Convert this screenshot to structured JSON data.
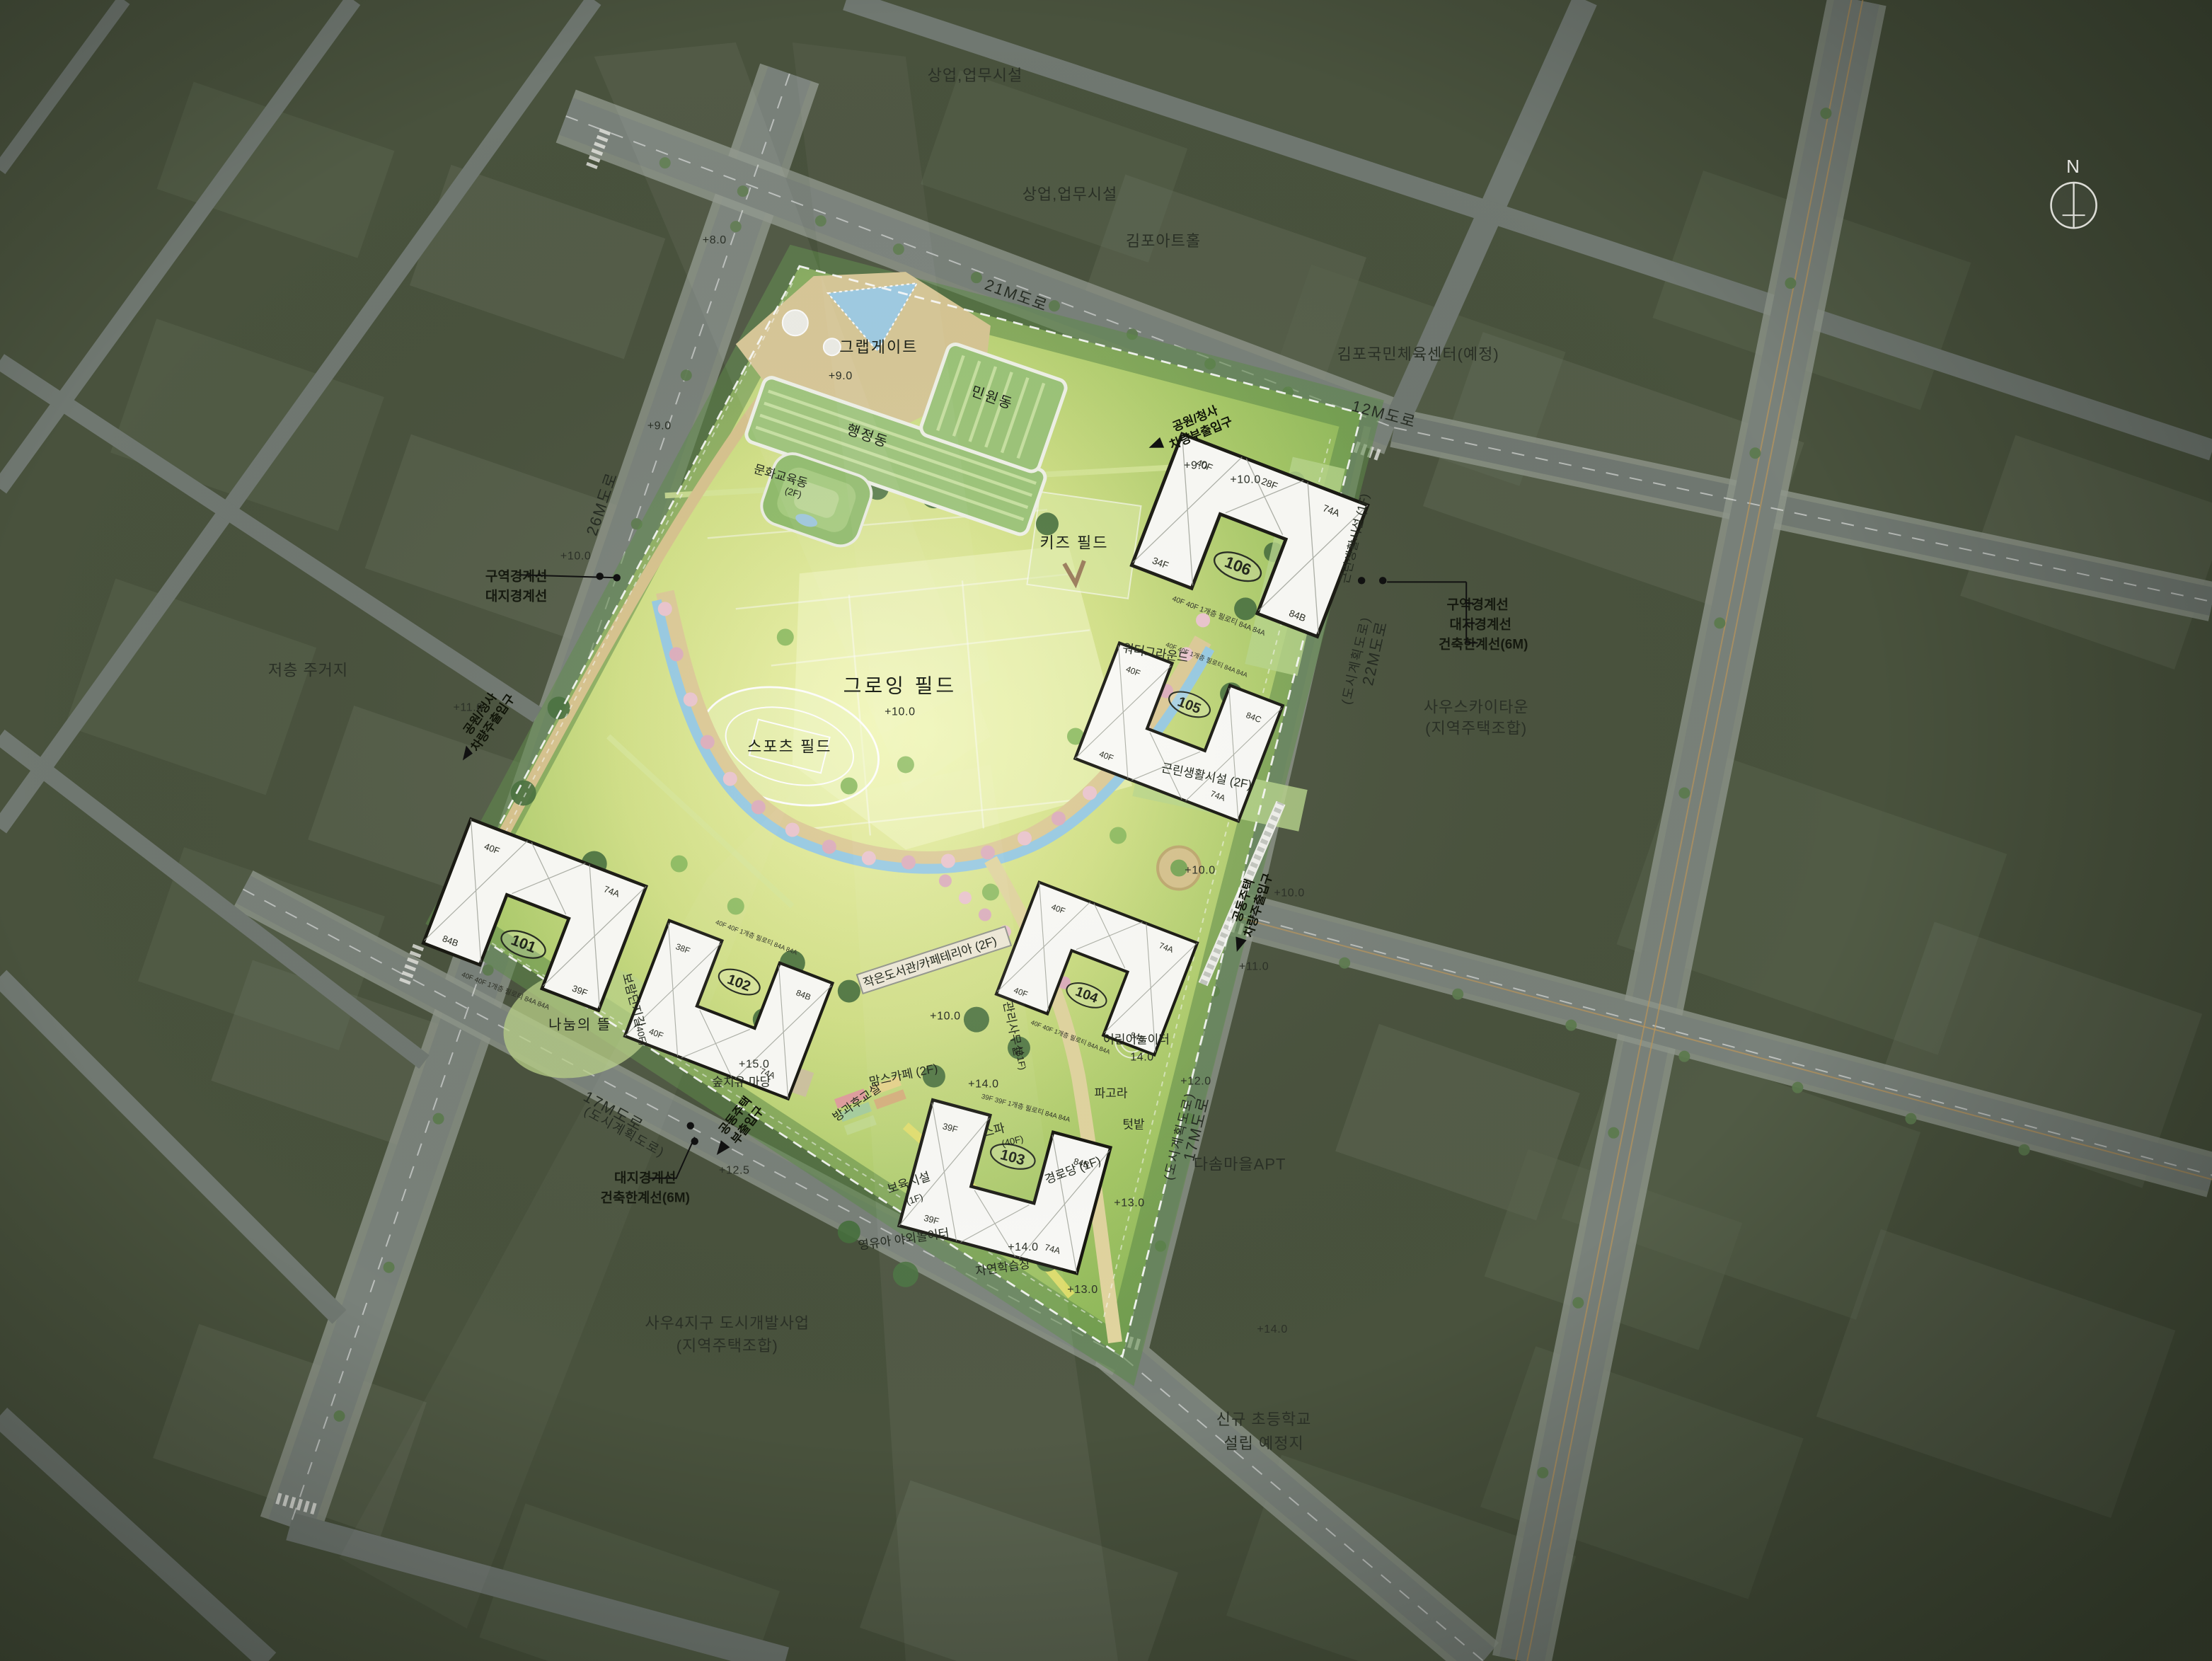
{
  "compass": {
    "north": "N"
  },
  "context": {
    "commercial1": "상업,업무시설",
    "commercial2": "상업,업무시설",
    "art_hall": "김포아트홀",
    "sports_center": "김포국민체육센터(예정)",
    "south_sky_town": "사우스카이타운",
    "south_sky_town_sub": "(지역주택조합)",
    "dasom_apt": "다솜마을APT",
    "new_school_l1": "신규 초등학교",
    "new_school_l2": "설립 예정지",
    "sawoo_l1": "사우4지구 도시개발사업",
    "sawoo_l2": "(지역주택조합)",
    "lowrise": "저층 주거지"
  },
  "roads": {
    "r21": "21M도로",
    "r12": "12M도로",
    "r26": "26M도로",
    "r22": "22M도로",
    "r22_sub": "(도시계획도로)",
    "r17a": "17M도로",
    "r17a_sub": "(도시계획도로)",
    "r17b": "17M도로",
    "r17b_sub": "(도시계획도로)"
  },
  "site": {
    "gate": "그랩게이트",
    "growing_field": "그로잉 필드",
    "growing_field_level": "+10.0",
    "sports_field": "스포츠 필드",
    "kids_field": "키즈 필드",
    "water_ground": "워터그라운드",
    "admin": "행정동",
    "civil": "민원동",
    "culture_edu": "문화교육동",
    "culture_edu_floor": "(2F)",
    "neighborhood1": "근린생활시설 (1F)",
    "neighborhood2": "근린생활시설 (2F)",
    "library": "작은도서관/카페테리아 (2F)",
    "mgmt_office": "관리사무실",
    "mgmt_office_floor": "(B1F)",
    "moms_cafe": "맘스카페 (2F)",
    "afterschool": "방과후교실",
    "daycare": "보육시설",
    "daycare_floor": "(1F)",
    "senior": "경로당 (1F)",
    "infant_playground": "영유아 야외놀이터",
    "nature_learning": "자연학습장",
    "children_playground": "어린이놀이터",
    "children_playground_level": "14.0",
    "pergola": "파고라",
    "garden": "텃밭",
    "sharing_yard": "나눔의 뜰",
    "healing_yard": "숲치유 마당",
    "spa": "스파",
    "spa_floor": "(40F)",
    "deck_path": "보람단지길",
    "deck_path_floor": "(40F)"
  },
  "entrances": {
    "park_main_l1": "공원/청사",
    "park_main_l2": "차량주출입구",
    "park_sub_l1": "공원/청사",
    "park_sub_l2": "차량부출입구",
    "apt_main_l1": "공동주택",
    "apt_main_l2": "차량주출입구",
    "apt_sub_l1": "공동주택",
    "apt_sub_l2": "부출입구"
  },
  "boundaries": {
    "zone": "구역경계선",
    "site": "대지경계선",
    "limit": "건축한계선(6M)"
  },
  "apartments": [
    {
      "no": "101",
      "f1": "40F",
      "f2": "39F",
      "u1": "74A",
      "u2": "84B",
      "piloti": "40F 40F 1개층 필로티 84A 84A"
    },
    {
      "no": "102",
      "f1": "40F",
      "f2": "38F",
      "u1": "74A",
      "u2": "84B",
      "piloti": "40F 40F 1개층 필로티 84A 84A"
    },
    {
      "no": "103",
      "f1": "39F",
      "f2": "39F",
      "u1": "74A",
      "u2": "84B",
      "piloti": "39F 39F 1개층 필로티 84A 84A"
    },
    {
      "no": "104",
      "f1": "40F",
      "f2": "40F",
      "u1": "74A",
      "u2": "84B",
      "piloti": "40F 40F 1개층 필로티 84A 84A"
    },
    {
      "no": "105",
      "f1": "40F",
      "f2": "40F",
      "u1": "74A",
      "u2": "84C",
      "piloti": "40F 40F 1개층 필로티 84A 84A"
    },
    {
      "no": "106",
      "f1": "40F",
      "f2": "34F",
      "f3": "28F",
      "u1": "74A",
      "u2": "84B",
      "piloti": "40F 40F 1개층 필로티 84A 84A"
    }
  ],
  "elevations": [
    {
      "t": "+8.0"
    },
    {
      "t": "+9.0"
    },
    {
      "t": "+9.0"
    },
    {
      "t": "+9.0"
    },
    {
      "t": "+10.0"
    },
    {
      "t": "+10.0"
    },
    {
      "t": "+10.0"
    },
    {
      "t": "+10.0"
    },
    {
      "t": "+10.0"
    },
    {
      "t": "+11.0"
    },
    {
      "t": "+11.0"
    },
    {
      "t": "+12.0"
    },
    {
      "t": "+12.5"
    },
    {
      "t": "+13.0"
    },
    {
      "t": "+13.0"
    },
    {
      "t": "+14.0"
    },
    {
      "t": "+14.0"
    },
    {
      "t": "+14.0"
    },
    {
      "t": "+15.0"
    }
  ]
}
